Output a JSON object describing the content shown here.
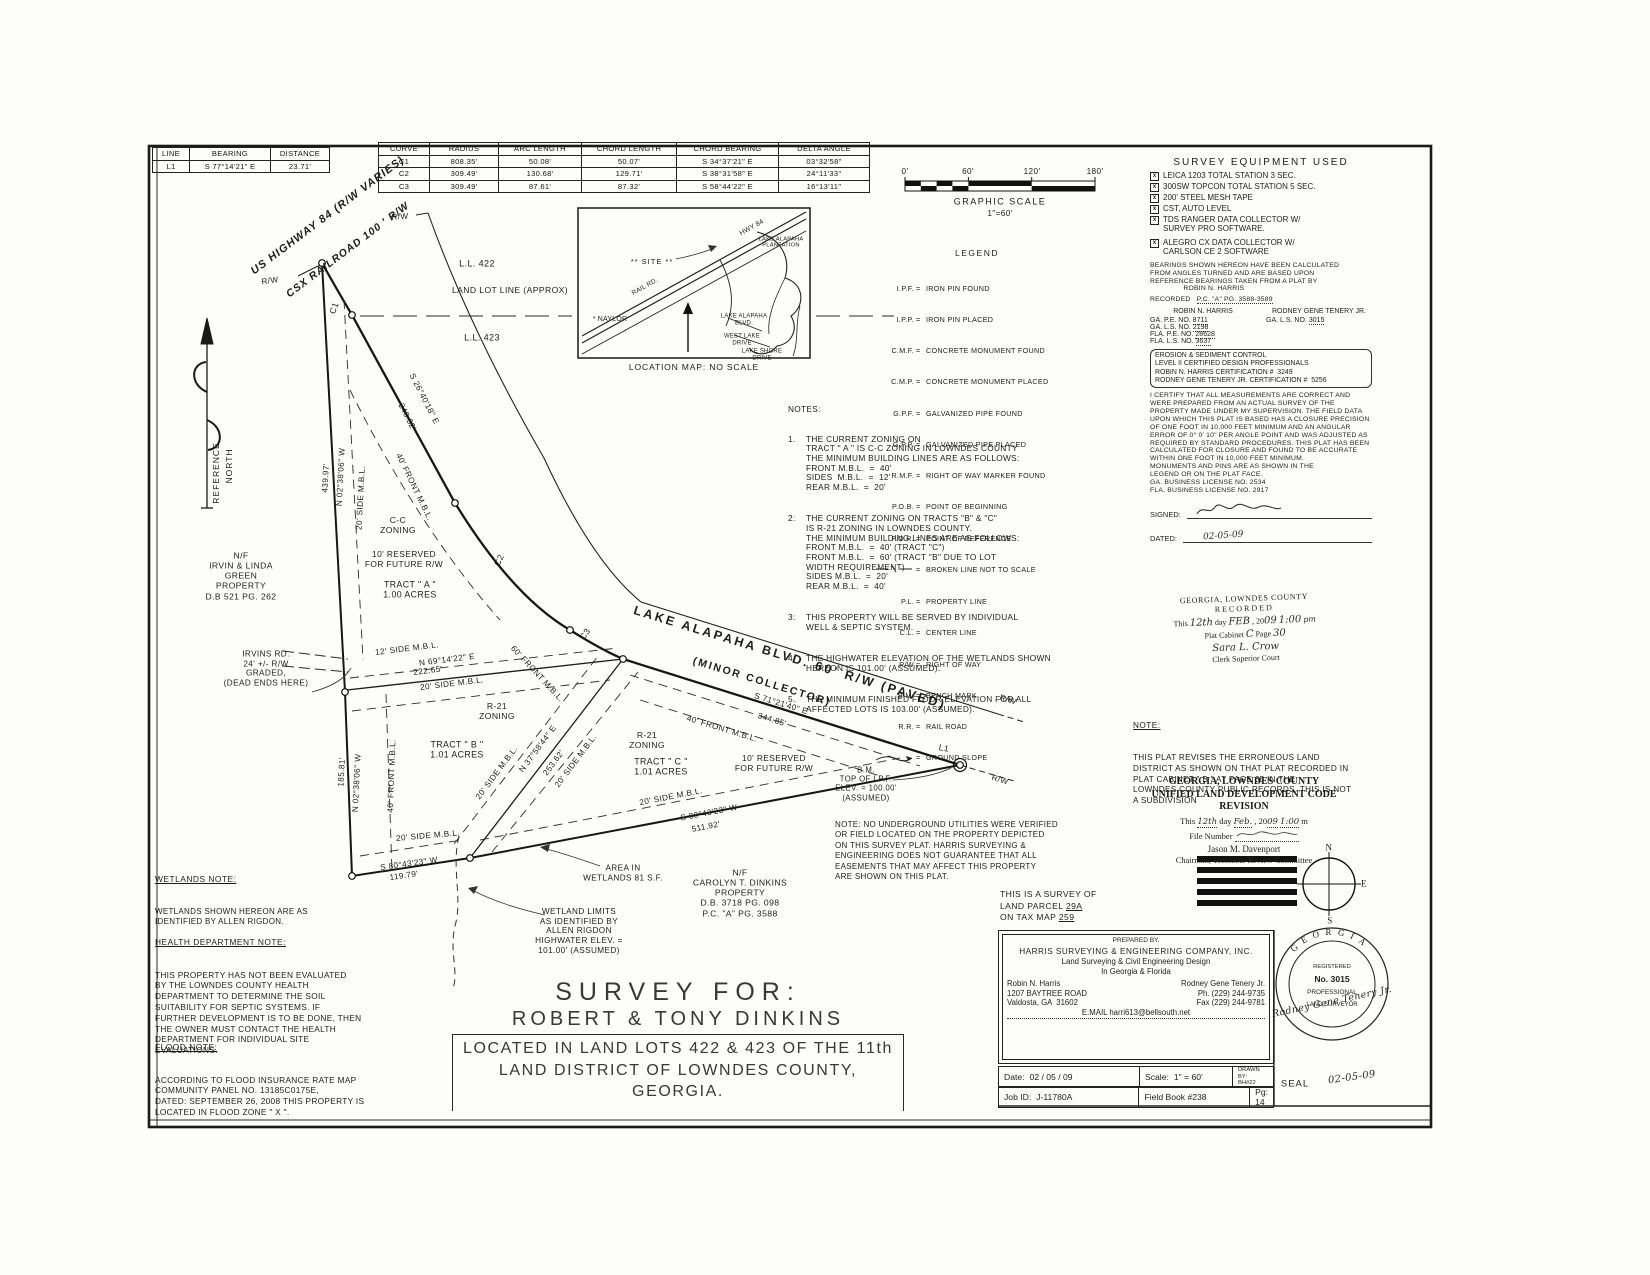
{
  "line_table": {
    "headers": [
      "LINE",
      "BEARING",
      "DISTANCE"
    ],
    "rows": [
      [
        "L1",
        "S 77°14'21\" E",
        "23.71'"
      ]
    ]
  },
  "curve_table": {
    "headers": [
      "CURVE",
      "RADIUS",
      "ARC LENGTH",
      "CHORD LENGTH",
      "CHORD BEARING",
      "DELTA ANGLE"
    ],
    "rows": [
      [
        "C1",
        "808.35'",
        "50.08'",
        "50.07'",
        "S 34°37'21\" E",
        "03°32'58\""
      ],
      [
        "C2",
        "309.49'",
        "130.68'",
        "129.71'",
        "S 38°31'58\" E",
        "24°11'33\""
      ],
      [
        "C3",
        "309.49'",
        "87.61'",
        "87.32'",
        "S 58°44'22\" E",
        "16°13'11\""
      ]
    ]
  },
  "graphic_scale": {
    "ticks": [
      "0'",
      "60'",
      "120'",
      "180'"
    ],
    "title": "GRAPHIC SCALE",
    "ratio": "1\"=60'"
  },
  "equipment": {
    "title": "SURVEY EQUIPMENT USED",
    "box": "x",
    "items": [
      "LEICA 1203 TOTAL STATION 3 SEC.",
      "300SW TOPCON TOTAL STATION 5 SEC.",
      "200' STEEL MESH TAPE",
      "CST, AUTO LEVEL",
      "TDS RANGER DATA COLLECTOR W/\nSURVEY PRO SOFTWARE.",
      "ALEGRO CX DATA COLLECTOR W/\nCARLSON CE 2 SOFTWARE"
    ]
  },
  "legend": {
    "title": "LEGEND",
    "eq": "=",
    "items": [
      {
        "a": "I.P.F.",
        "d": "IRON PIN FOUND"
      },
      {
        "a": "I.P.P.",
        "d": "IRON PIN PLACED"
      },
      {
        "a": "C.M.F.",
        "d": "CONCRETE MONUMENT FOUND"
      },
      {
        "a": "C.M.P.",
        "d": "CONCRETE MONUMENT PLACED"
      },
      {
        "a": "G.P.F.",
        "d": "GALVANIZED PIPE FOUND"
      },
      {
        "a": "G.P.P.",
        "d": "GALVANIZED PIPE PLACED"
      },
      {
        "a": "R.M.F.",
        "d": "RIGHT OF WAY MARKER FOUND"
      },
      {
        "a": "P.O.B.",
        "d": "POINT OF BEGINNING"
      },
      {
        "a": "P.O.R.",
        "d": "POINT OF REFERENCE"
      },
      {
        "a": "",
        "d": "BROKEN LINE NOT TO SCALE"
      },
      {
        "a": "P.L.",
        "d": "PROPERTY LINE"
      },
      {
        "a": "C.L.",
        "d": "CENTER LINE"
      },
      {
        "a": "R/W",
        "d": "RIGHT OF WAY"
      },
      {
        "a": "B.M.",
        "d": "BENCH MARK"
      },
      {
        "a": "R.R.",
        "d": "RAIL ROAD"
      },
      {
        "a": "",
        "d": "GROUND SLOPE"
      }
    ]
  },
  "map": {
    "site": "** SITE **",
    "naylor": "* NAYLOR",
    "hwy": "HWY 84",
    "rail": "RAIL RD.",
    "plantation": "LAKE ALAPAHA\nPLANTATION",
    "blvd": "LAKE ALAPAHA\nBLVD.",
    "westlake": "WEST LAKE\nDRIVE",
    "lakeshore": "LAKE SHORE\nDRIVE",
    "caption": "LOCATION MAP:  NO SCALE"
  },
  "notes": {
    "title": "NOTES:",
    "items": [
      {
        "n": "1.",
        "t": "THE CURRENT ZONING ON\nTRACT \" A \" IS C-C ZONING IN LOWNDES COUNTY\nTHE MINIMUM BUILDING LINES ARE AS FOLLOWS:\nFRONT M.B.L.  =  40'\nSIDES  M.B.L.  =  12'\nREAR M.B.L.  =  20'"
      },
      {
        "n": "2:",
        "t": "THE CURRENT ZONING ON TRACTS \"B\" & \"C\"\nIS R-21 ZONING IN LOWNDES COUNTY.\nTHE MINIMUM BUILDING LINES ARE AS FOLLOWS:\nFRONT M.B.L.  =  40' (TRACT \"C\")\nFRONT M.B.L.  =  60' (TRACT \"B\" DUE TO LOT\nWIDTH REQUIREMENT)\nSIDES M.B.L.  =  20'\nREAR M.B.L.  =  40'"
      },
      {
        "n": "3:",
        "t": "THIS PROPERTY WILL BE SERVED BY INDIVIDUAL\nWELL & SEPTIC SYSTEM."
      },
      {
        "n": "4:",
        "t": "THE HIGHWATER ELEVATION OF THE WETLANDS SHOWN\nHEREON IS 101.00' (ASSUMED)."
      },
      {
        "n": "5.",
        "t": "THE MINIMUM FINISHED FLOOR ELEVATION FOR ALL\nAFFECTED LOTS IS 103.00' (ASSUMED)."
      }
    ]
  },
  "plat": {
    "us_hwy": "US HIGHWAY 84 (R/W VARIES)",
    "csx": "CSX RAILROAD 100 ' R/W",
    "rw": "R/W",
    "ll422": "L.L. 422",
    "lll": "LAND LOT LINE (APPROX)",
    "ll423": "L.L. 423",
    "b_west": "N 02°38'06\" W",
    "d_west_u": "439.97'",
    "d_west_l": "185.81'",
    "b_rr": "S 26°40'18\" E",
    "d_rr": "248.32'",
    "b_divA": "N 69°14'22\" E",
    "d_divA": "222.65'",
    "b_divBC": "N 37°58'44\" E",
    "d_divBC": "253.62'",
    "b_blvd": "S 71°21'40\" E",
    "d_blvd": "344.85'",
    "b_bot": "S 80°43'23\" W",
    "d_bot_l": "511.92'",
    "d_bot_s": "119.79'",
    "side20": "20' SIDE M.B.L.",
    "side12": "12' SIDE M.B.L.",
    "front40": "40' FRONT M.B.L.",
    "front60": "60' FRONT M.B.L.",
    "res10": "10' RESERVED\nFOR FUTURE R/W",
    "cc": "C-C\nZONING",
    "r21": "R-21\nZONING",
    "tractA": "TRACT \" A \"\n1.00 ACRES",
    "tractB": "TRACT \" B \"\n1.01 ACRES",
    "tractC": "TRACT \" C \"\n1.01 ACRES",
    "c1": "C1",
    "c2": "C2",
    "c3": "C3",
    "l1": "L1",
    "blvd_name": "LAKE ALAPAHA BLVD. 60' R/W (PAVED)",
    "blvd_sub": "(MINOR COLLECTOR)",
    "bm": "B.M.\nTOP OF I.P.F.\nELEV. = 100.00'\n(ASSUMED)",
    "irvins": "IRVINS RD.\n24' +/- R/W\nGRADED,\n(DEAD ENDS HERE)",
    "green": "N/F\nIRVIN & LINDA\nGREEN\nPROPERTY\nD.B 521 PG. 262",
    "dinkins": "N/F\nCAROLYN T. DINKINS\nPROPERTY\nD.B. 3718 PG. 098\nP.C. \"A\" PG. 3588",
    "wet_area": "AREA IN\nWETLANDS 81 S.F.",
    "wet_limits": "WETLAND LIMITS\nAS IDENTIFIED BY\nALLEN RIGDON\nHIGHWATER ELEV. =\n101.00' (ASSUMED)",
    "ref1": "REFERENCE",
    "ref2": "NORTH",
    "util_note": "NOTE: NO UNDERGROUND UTILITIES WERE VERIFIED\nOR FIELD LOCATED ON THE PROPERTY DEPICTED\nON THIS SURVEY PLAT. HARRIS SURVEYING &\nENGINEERING DOES NOT GUARANTEE THAT ALL\nEASEMENTS THAT MAY AFFECT THIS PROPERTY\nARE SHOWN ON THIS PLAT."
  },
  "left_notes": {
    "wetlands": {
      "h": "WETLANDS NOTE:",
      "b": "WETLANDS SHOWN HEREON ARE AS\nIDENTIFIED BY ALLEN RIGDON."
    },
    "health": {
      "h": "HEALTH DEPARTMENT NOTE:",
      "b": "THIS PROPERTY HAS NOT BEEN EVALUATED\nBY THE LOWNDES COUNTY HEALTH\nDEPARTMENT TO DETERMINE THE SOIL\nSUITABILITY FOR SEPTIC SYSTEMS. IF\nFURTHER DEVELOPMENT IS TO BE DONE, THEN\nTHE OWNER MUST CONTACT THE HEALTH\nDEPARTMENT FOR INDIVIDUAL SITE\nEVALUATIONS."
    },
    "flood": {
      "h": "FLOOD NOTE:",
      "b": "ACCORDING TO FLOOD INSURANCE RATE MAP\nCOMMUNITY PANEL NO. 13185C0175E,\nDATED: SEPTEMBER 26, 2008 THIS PROPERTY IS\nLOCATED IN FLOOD ZONE \" X \"."
    }
  },
  "right": {
    "bearings_note": "BEARINGS SHOWN HEREON HAVE BEEN CALCULATED\nFROM ANGLES TURNED AND ARE BASED UPON\nREFERENCE BEARINGS TAKEN FROM A PLAT BY\n                ROBIN N. HARRIS",
    "recorded_label": "RECORDED",
    "recorded_value": "P.C. \"A\" PG. 3588-3589",
    "pro_left_name": "ROBIN N. HARRIS",
    "pro_right_name": "RODNEY GENE TENERY JR.",
    "pro_left": [
      {
        "l": "GA. P.E. NO.",
        "v": "8711"
      },
      {
        "l": "GA. L.S. NO.",
        "v": "2198"
      },
      {
        "l": "FLA. P.E. NO.",
        "v": "28628"
      },
      {
        "l": "FLA. L.S. NO.",
        "v": "3637"
      }
    ],
    "pro_right": [
      {
        "l": "GA. L.S. NO.",
        "v": "3015"
      }
    ],
    "erosion": "EROSION & SEDIMENT CONTROL\nLEVEL II CERTIFIED DESIGN PROFESSIONALS\nROBIN N. HARRIS CERTIFICATION #  3249\nRODNEY GENE TENERY JR. CERTIFICATION #  5256",
    "certification": "I CERTIFY THAT ALL MEASUREMENTS ARE CORRECT AND WERE PREPARED FROM AN ACTUAL SURVEY OF THE PROPERTY MADE UNDER MY SUPERVISION. THE FIELD DATA UPON WHICH THIS PLAT IS BASED HAS A CLOSURE PRECISION OF ONE FOOT IN 10,000 FEET MINIMUM AND AN ANGULAR ERROR OF 0° 0' 10\" PER ANGLE POINT AND WAS ADJUSTED AS REQUIRED BY STANDARD PROCEDURES. THIS PLAT HAS BEEN CALCULATED FOR CLOSURE AND FOUND TO BE ACCURATE WITHIN ONE FOOT IN 10,000 FEET MINIMUM.\nMONUMENTS AND PINS ARE AS SHOWN IN THE\nLEGEND OR ON THE PLAT FACE.\nGA. BUSINESS LICENSE NO. 2534\nFLA. BUSINESS LICENSE NO. 2917",
    "signed_label": "SIGNED:",
    "dated_label": "DATED:",
    "dated_value": "02-05-09",
    "stamp": {
      "l1": "GEORGIA, LOWNDES COUNTY",
      "l2": "RECORDED",
      "this": "This",
      "day": "12th",
      "day_word": "day",
      "month": "FEB",
      "year_pre": ", 20",
      "year": "09",
      "time": "1:00",
      "ampm": "pm",
      "cab_label": "Plat Cabinet",
      "cab": "C",
      "page_label": "Page",
      "page": "30",
      "clerk": "Sara L. Crow",
      "court": "Clerk Superior Court"
    },
    "revision_note": {
      "h": "NOTE:",
      "b": "THIS PLAT REVISES THE ERRONEOUS LAND\nDISTRICT AS SHOWN ON THAT PLAT RECORDED IN\nPLAT CABINET \" B \" AT PAGE 65 IN THE\nLOWNDES COUNTY PUBLIC RECORDS. THIS IS NOT\nA SUBDIVISION"
    },
    "uldc": {
      "t1": "GEORGIA, LOWNDES COUNTY",
      "t2": "UNIFIED LAND DEVELOPMENT CODE",
      "t3": "REVISION",
      "this_label": "This",
      "day_label": "day",
      "year_label": ", 20",
      "m_label": "m",
      "hw_day": "12th",
      "hw_month": "Feb.",
      "hw_year": "09",
      "hw_time": "1:00",
      "file_label": "File Number",
      "name": "Jason M. Davenport",
      "chair": "Chairman, Technical Review Committee"
    },
    "survey_of": {
      "l1": "THIS IS A SURVEY OF",
      "l2a": "LAND PARCEL",
      "l2b": "29A",
      "l3a": "ON TAX MAP",
      "l3b": "259"
    },
    "prepared": {
      "label": "PREPARED BY.",
      "company": "HARRIS SURVEYING & ENGINEERING COMPANY, INC.",
      "sub1": "Land Surveying & Civil Engineering Design",
      "sub2": "In Georgia & Florida",
      "left": "Robin N. Harris\n1207 BAYTREE ROAD\nValdosta, GA  31602",
      "right": "Rodney Gene Tenery Jr.\nPh. (229) 244-9735\nFax (229) 244-9781",
      "email": "E.MAIL   harri613@bellsouth.net"
    },
    "title_rows": {
      "date_l": "Date:",
      "date": "02 / 05 / 09",
      "scale_l": "Scale:",
      "scale": "1\" = 60'",
      "drawn_l": "DRAWN BY:",
      "drawn": "BH#22",
      "job_l": "Job ID:",
      "job": "J-11780A",
      "fb": "Field Book #238",
      "pg": "Pg: 14"
    },
    "seal": {
      "state": "GEORGIA",
      "reg": "REGISTERED",
      "no": "No. 3015",
      "prof": "PROFESSIONAL",
      "ls": "LAND SURVEYOR",
      "sig": "Rodney Gene Tenery Jr.",
      "label": "SEAL",
      "date": "02-05-09"
    },
    "compass": {
      "n": "N",
      "e": "E",
      "s": "S"
    }
  },
  "title": {
    "l1": "SURVEY FOR:",
    "l2": "ROBERT & TONY DINKINS",
    "l3": "LOCATED IN LAND LOTS 422 & 423 OF THE 11th",
    "l4": "LAND DISTRICT OF LOWNDES COUNTY, GEORGIA."
  }
}
